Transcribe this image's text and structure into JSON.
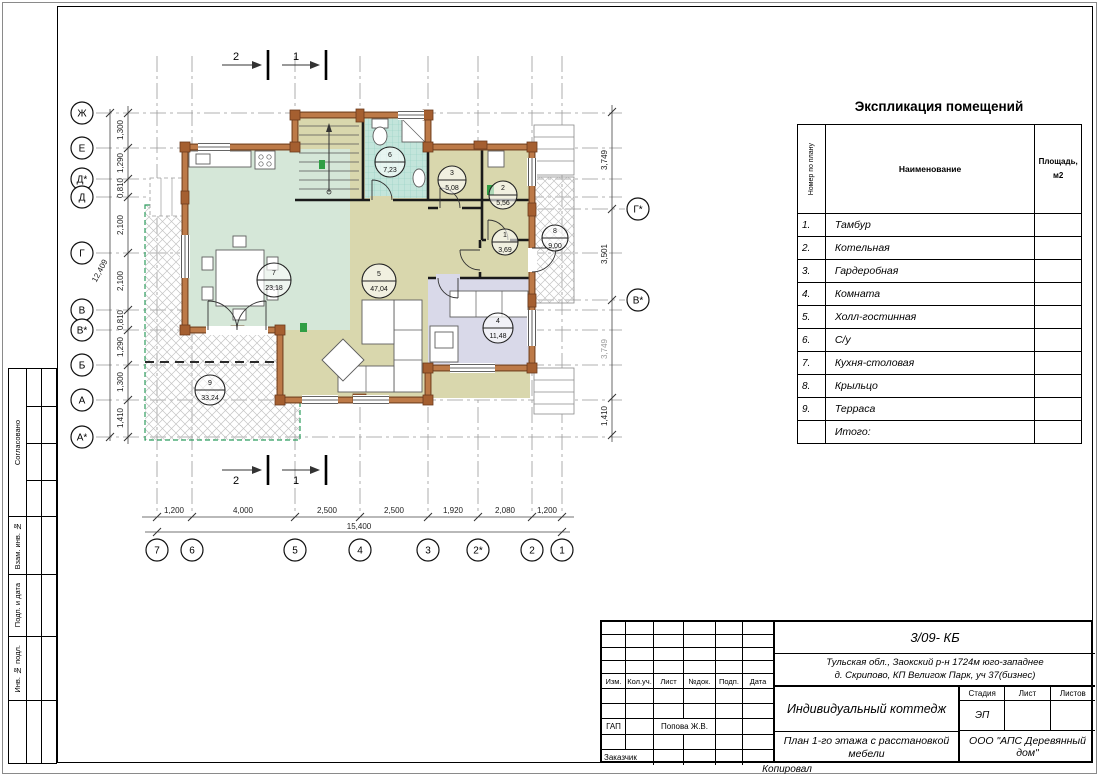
{
  "sheet": {
    "copied_label": "Копировал",
    "side_labels": [
      "Согласовано",
      "Взам. инв. №",
      "Подп. и дата",
      "Инв. № подл."
    ]
  },
  "explication": {
    "title": "Экспликация помещений",
    "columns": {
      "number": "Номер по плану",
      "name": "Наименование",
      "area_line1": "Площадь,",
      "area_line2": "м2"
    },
    "rows": [
      {
        "num": "1.",
        "name": "Тамбур",
        "area": ""
      },
      {
        "num": "2.",
        "name": "Котельная",
        "area": ""
      },
      {
        "num": "3.",
        "name": "Гардеробная",
        "area": ""
      },
      {
        "num": "4.",
        "name": "Комната",
        "area": ""
      },
      {
        "num": "5.",
        "name": "Холл-гостинная",
        "area": ""
      },
      {
        "num": "6.",
        "name": "С/у",
        "area": ""
      },
      {
        "num": "7.",
        "name": "Кухня-столовая",
        "area": ""
      },
      {
        "num": "8.",
        "name": "Крыльцо",
        "area": ""
      },
      {
        "num": "9.",
        "name": "Терраса",
        "area": ""
      },
      {
        "num": "",
        "name": "Итого:",
        "area": ""
      }
    ]
  },
  "plan": {
    "axes_left": [
      "Ж",
      "Е",
      "Д*",
      "Д",
      "Г",
      "В",
      "В*",
      "Б",
      "А",
      "А*"
    ],
    "axes_right": [
      "Г*",
      "В*"
    ],
    "axes_bottom": [
      "7",
      "6",
      "5",
      "4",
      "3",
      "2*",
      "2",
      "1"
    ],
    "dims_left": [
      "1,300",
      "1,290",
      "0,810",
      "2,100",
      "2,100",
      "0,810",
      "1,290",
      "1,300",
      "1,410"
    ],
    "total_left": "12,409",
    "dims_bottom": [
      "1,200",
      "4,000",
      "2,500",
      "2,500",
      "1,920",
      "2,080",
      "1,200"
    ],
    "total_bottom": "15,400",
    "dims_right": [
      "3,749",
      "3,501",
      "3,749",
      "1,410"
    ],
    "section_marks": [
      "2",
      "1"
    ],
    "rooms": [
      {
        "num": "7",
        "area": "23,18"
      },
      {
        "num": "5",
        "area": "47,04"
      },
      {
        "num": "6",
        "area": "7,23"
      },
      {
        "num": "3",
        "area": "5,08"
      },
      {
        "num": "2",
        "area": "5,56"
      },
      {
        "num": "1",
        "area": "3,69"
      },
      {
        "num": "8",
        "area": "9,00"
      },
      {
        "num": "4",
        "area": "11,48"
      },
      {
        "num": "9",
        "area": "33,24"
      }
    ],
    "colors": {
      "kitchen": "#d5e7d8",
      "hall": "#d9d7ad",
      "bathroom": "#c3e5db",
      "bedroom": "#d9d9e9",
      "wall_log": "#bd7a48",
      "terrace_edge": "#2f9e5f"
    }
  },
  "titleblock": {
    "code": "3/09- КБ",
    "address_line1": "Тульская обл., Заокский р-н 1724м юго-западнее",
    "address_line2": "д. Скрипово, КП Велигож Парк, уч 37(бизнес)",
    "header_cells": [
      "Изм.",
      "Кол.уч.",
      "Лист",
      "№док.",
      "Подп.",
      "Дата"
    ],
    "gap_label": "ГАП",
    "gap_value": "Попова Ж.В.",
    "customer_label": "Заказчик",
    "project": "Индивидуальный коттедж",
    "title_line1": "План 1-го этажа с расстановкой",
    "title_line2": "мебели",
    "stage_label": "Стадия",
    "sheet_label": "Лист",
    "sheets_label": "Листов",
    "stage_value": "ЭП",
    "company_line1": "ООО \"АПС Деревянный",
    "company_line2": "дом\""
  }
}
